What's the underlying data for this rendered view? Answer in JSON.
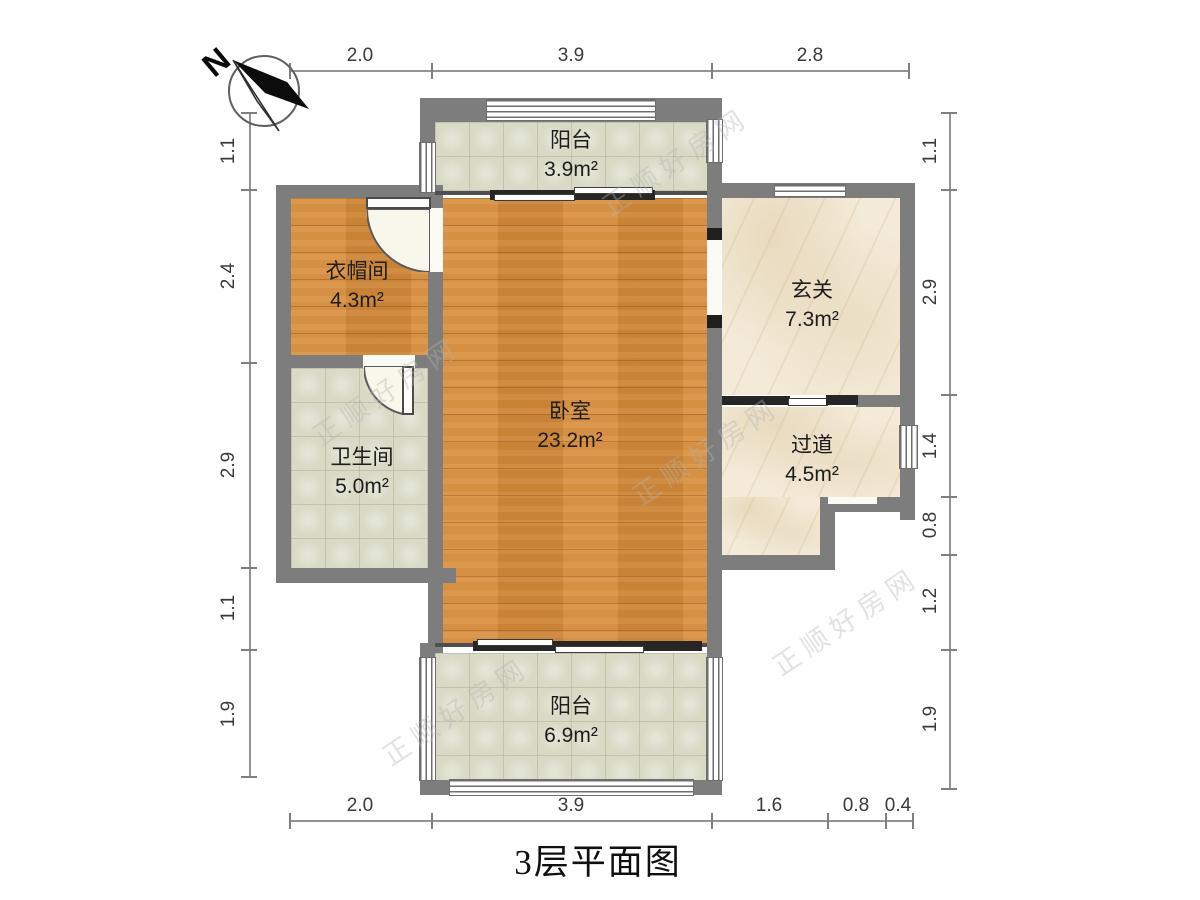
{
  "title": "3层平面图",
  "compass": {
    "label": "N"
  },
  "watermark": "正顺好房网",
  "rooms": {
    "balcony_top": {
      "name": "阳台",
      "area": "3.9m²"
    },
    "cloakroom": {
      "name": "衣帽间",
      "area": "4.3m²"
    },
    "bathroom": {
      "name": "卫生间",
      "area": "5.0m²"
    },
    "bedroom": {
      "name": "卧室",
      "area": "23.2m²"
    },
    "entry": {
      "name": "玄关",
      "area": "7.3m²"
    },
    "corridor": {
      "name": "过道",
      "area": "4.5m²"
    },
    "balcony_bottom": {
      "name": "阳台",
      "area": "6.9m²"
    }
  },
  "dims": {
    "top": [
      "2.0",
      "3.9",
      "2.8"
    ],
    "bottom": [
      "2.0",
      "3.9",
      "1.6",
      "0.8",
      "0.4"
    ],
    "left": [
      "1.1",
      "2.4",
      "2.9",
      "1.1",
      "1.9"
    ],
    "right": [
      "1.1",
      "2.9",
      "1.4",
      "0.8",
      "1.2",
      "1.9"
    ]
  },
  "colors": {
    "wall": "#7d7d7d",
    "wood": "#d1893a",
    "tile": "#d8dac5",
    "marble": "#f3ead7"
  }
}
